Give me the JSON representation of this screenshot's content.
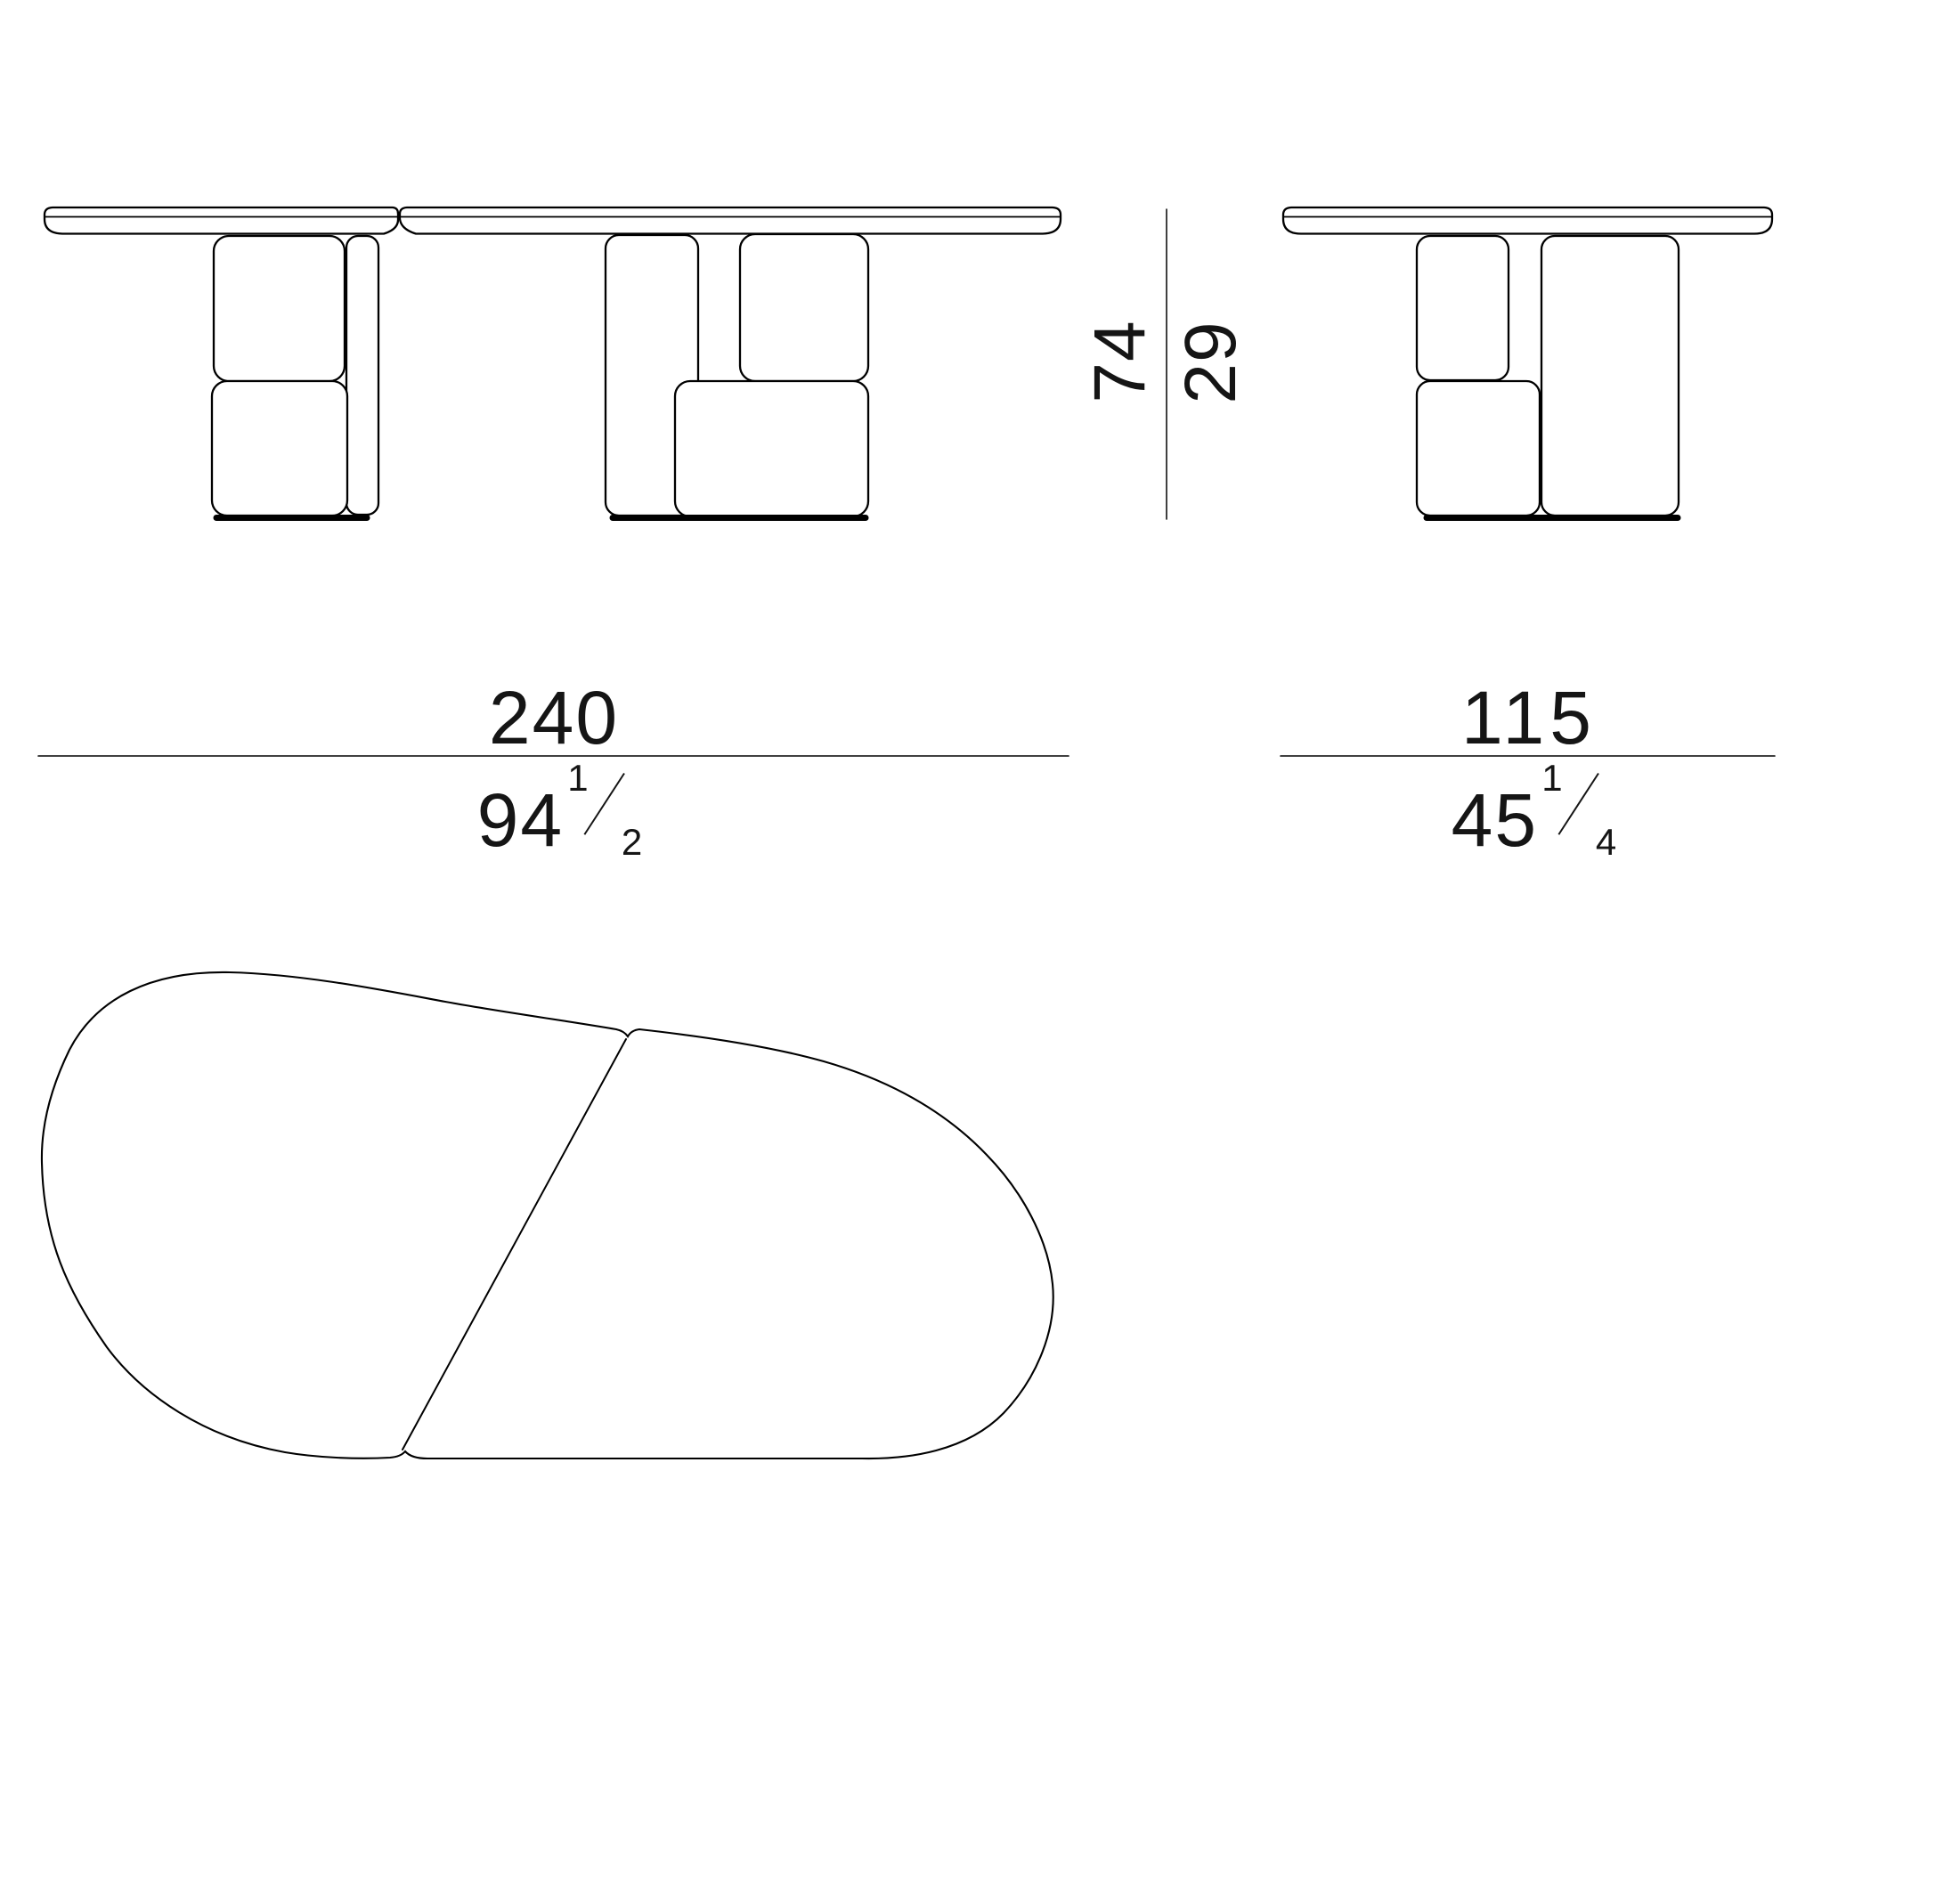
{
  "document": {
    "type": "furniture technical drawing",
    "background_color": "#ffffff",
    "line_color": "#000000",
    "text_color": "#151515"
  },
  "dimensions": {
    "length": {
      "cm": "240",
      "in_whole": "94",
      "in_num": "1",
      "in_den": "2"
    },
    "depth": {
      "cm": "115",
      "in_whole": "45",
      "in_num": "1",
      "in_den": "4"
    },
    "height": {
      "cm": "74",
      "in": "29"
    }
  }
}
